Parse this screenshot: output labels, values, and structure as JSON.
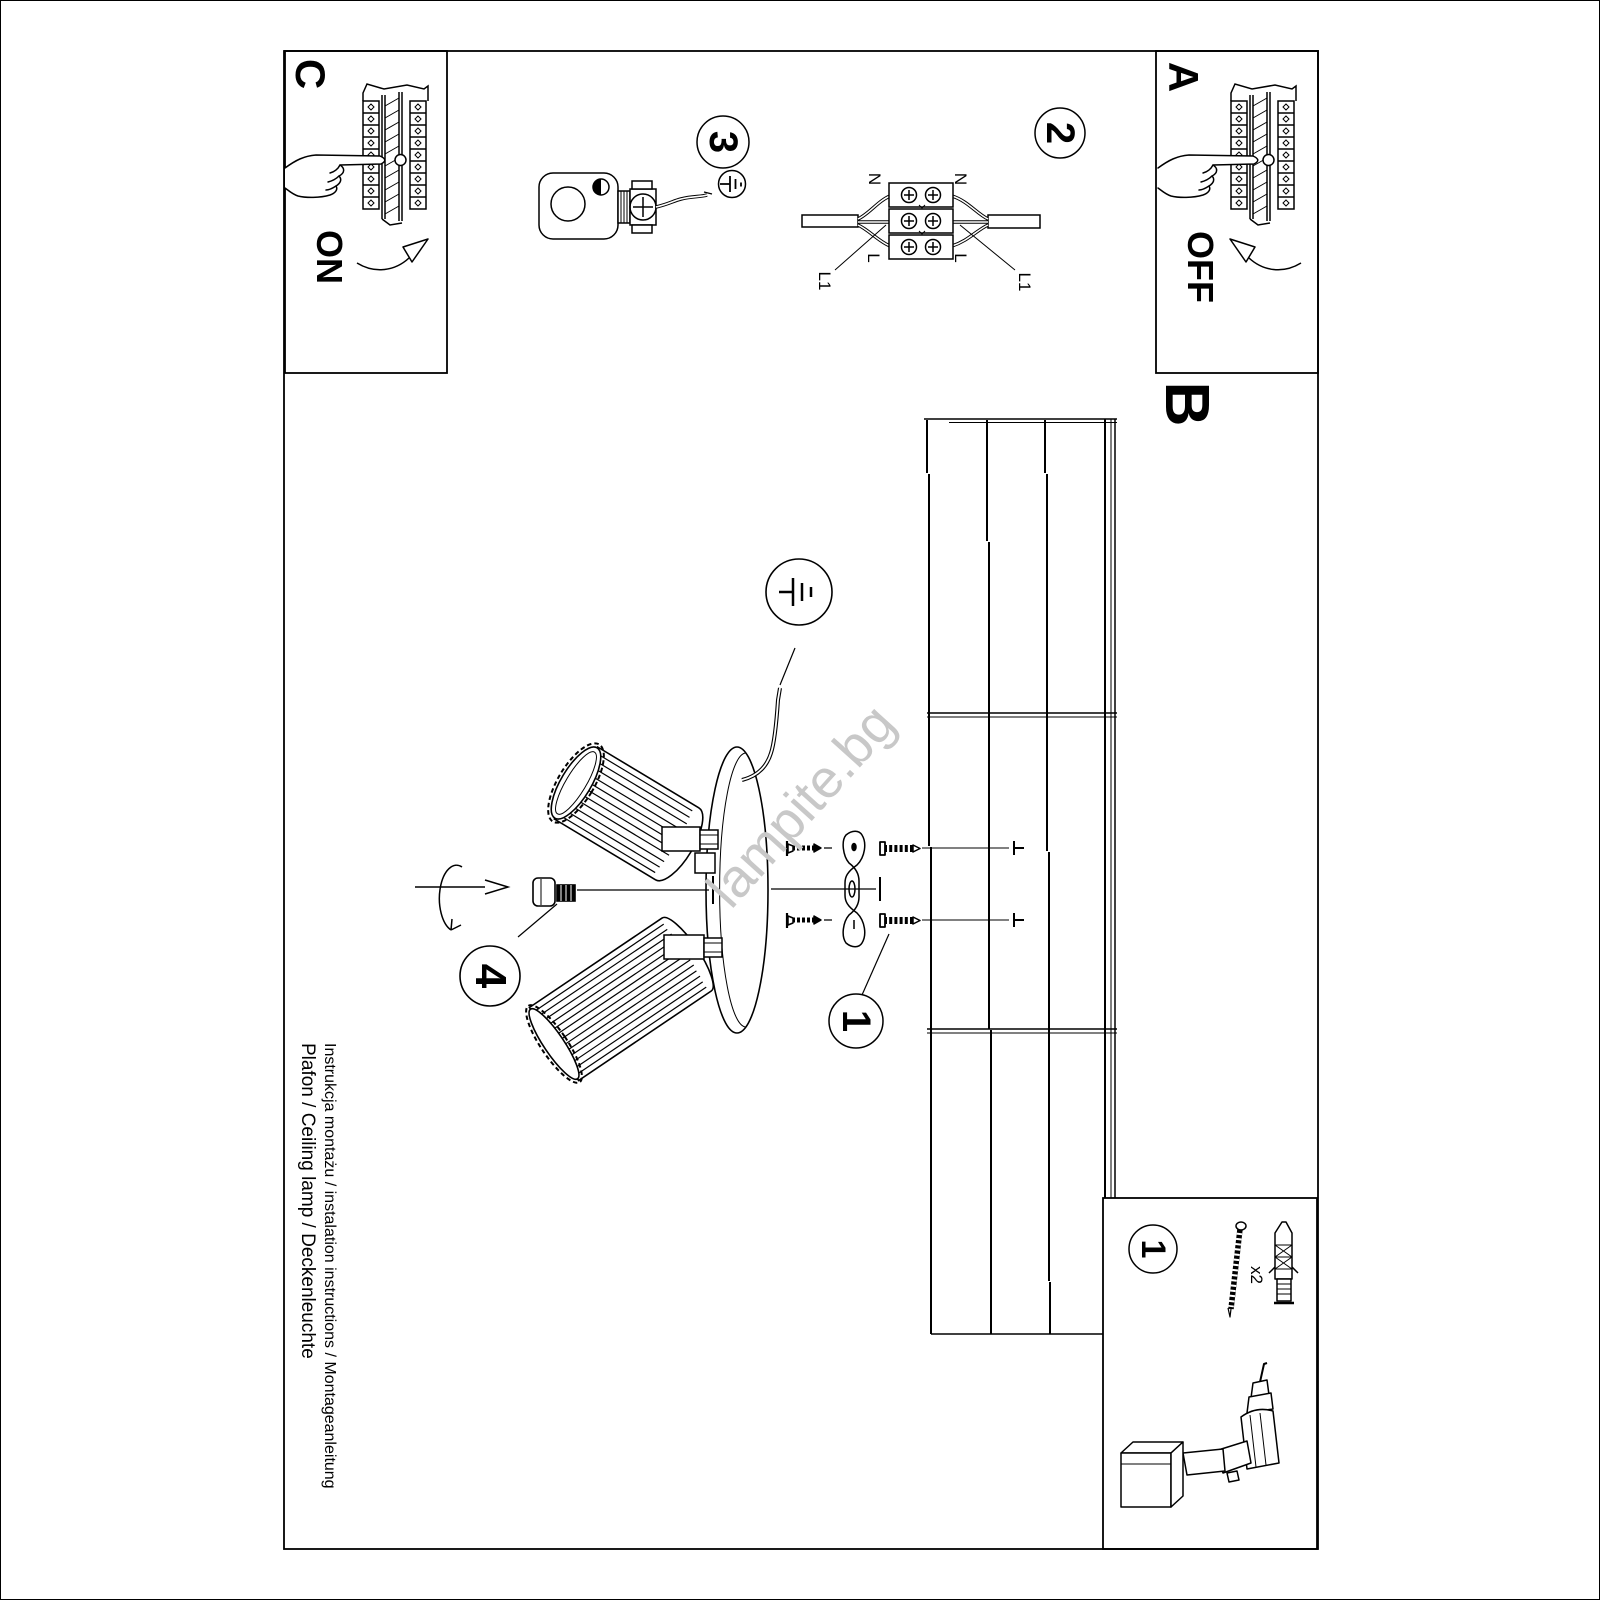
{
  "document": {
    "title_line1": "Instrukcja montażu / instalation instructions / Montageanleitung",
    "title_line2": "Plafon / Ceiling lamp / Deckenleuchte",
    "watermark": "lampite.bg"
  },
  "panels": {
    "a": {
      "label": "A",
      "state": "OFF"
    },
    "b": {
      "label": "B"
    },
    "c": {
      "label": "C",
      "state": "ON"
    }
  },
  "steps": {
    "step1": "1",
    "step2": "2",
    "step3": "3",
    "step4": "4"
  },
  "wiring": {
    "n_left": "N",
    "n_right": "N",
    "l_left": "L",
    "l_right": "L",
    "l1_left": "L1",
    "l1_right": "L1"
  },
  "toolbox": {
    "step_number": "1",
    "screw_quantity": "x2"
  },
  "icons": {
    "earth_symbol": "earth-ground-symbol",
    "hand": "pointing-hand",
    "arrow_on": "curved-arrow-up-right",
    "arrow_off": "curved-arrow-up-left",
    "rotate": "rotation-arrow",
    "drill": "cordless-drill"
  },
  "colors": {
    "ink": "#000000",
    "paper": "#ffffff",
    "watermark": "#c8c8c8"
  }
}
